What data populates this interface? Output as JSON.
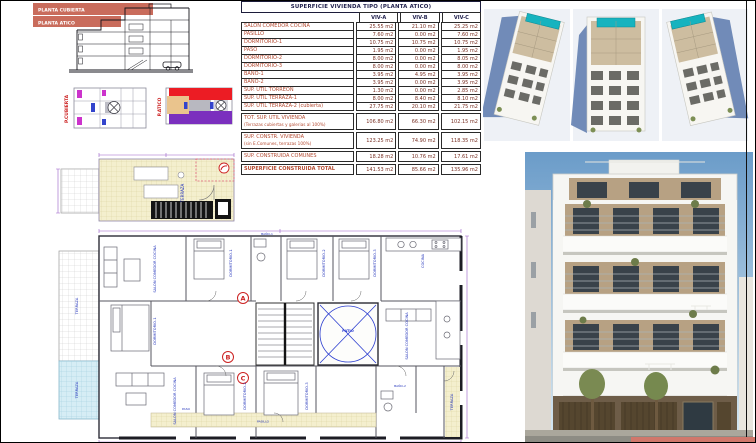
{
  "sheet": {
    "accent_band_color": "#c4604e",
    "salmon_bar_color": "#d1776b"
  },
  "section_drawing": {
    "band1": "PLANTA CUBIERTA",
    "band2": "PLANTA ATICO"
  },
  "key_plans": {
    "left_label": "P.CUBIERTA",
    "right_label": "P.ATICO"
  },
  "table": {
    "title": "SUPERFICIE VIVIENDA TIPO  (PLANTA ATICO)",
    "columns": [
      "VIV-A",
      "VIV-B",
      "VIV-C"
    ],
    "rows": [
      {
        "label": "SALON COMEDOR COCINA",
        "a": "25.55 m2",
        "b": "21.10 m2",
        "c": "25.25 m2"
      },
      {
        "label": "PASILLO",
        "a": "7.60 m2",
        "b": "0.00 m2",
        "c": "7.60 m2"
      },
      {
        "label": "DORMITORIO-1",
        "a": "10.75 m2",
        "b": "10.75 m2",
        "c": "10.75 m2"
      },
      {
        "label": "PASO",
        "a": "1.95 m2",
        "b": "0.00 m2",
        "c": "1.95 m2"
      },
      {
        "label": "DORMITORIO-2",
        "a": "8.00 m2",
        "b": "0.00 m2",
        "c": "8.05 m2"
      },
      {
        "label": "DORMITORIO-3",
        "a": "8.00 m2",
        "b": "0.00 m2",
        "c": "8.00 m2"
      },
      {
        "label": "BAÑO-1",
        "a": "3.95 m2",
        "b": "4.95 m2",
        "c": "3.95 m2"
      },
      {
        "label": "BAÑO-2",
        "a": "3.95 m2",
        "b": "0.00 m2",
        "c": "3.95 m2"
      },
      {
        "label": "SUP. ÚTIL TORREON",
        "a": "1.30 m2",
        "b": "0.00 m2",
        "c": "2.85 m2"
      },
      {
        "label": "SUP. ÚTIL TERRAZA-1",
        "a": "8.00 m2",
        "b": "8.40 m2",
        "c": "8.10 m2"
      },
      {
        "label": "SUP. ÚTIL TERRAZA-2 (cubierta)",
        "a": "27.75 m2",
        "b": "20.10 m2",
        "c": "21.75 m2"
      }
    ],
    "totals": [
      {
        "label": "TOT. SUP. UTIL VIVIENDA",
        "sub": "(Terrazas cubiertas y galerias al 100%)",
        "a": "106.80 m2",
        "b": "66.30 m2",
        "c": "102.15 m2"
      },
      {
        "label": "SUP. CONSTR. VIVIENDA",
        "sub": "(sin E.Comunes, terrazas 100%)",
        "a": "123.25 m2",
        "b": "74.90 m2",
        "c": "118.35 m2"
      },
      {
        "label": "SUP. CONSTRUIDA COMUNES",
        "sub": "",
        "a": "18.28 m2",
        "b": "10.76 m2",
        "c": "17.61 m2"
      },
      {
        "label": "SUPERFICIE CONSTRUIDA TOTAL",
        "sub": "",
        "a": "141.53 m2",
        "b": "85.66 m2",
        "c": "135.96 m2"
      }
    ]
  },
  "plan": {
    "rooms": {
      "terraza": "TERRAZA",
      "salon": "SALON COMEDOR COCINA",
      "dormitorio1": "DORMITORIO-1",
      "dormitorio2": "DORMITORIO-2",
      "dormitorio3": "DORMITORIO-3",
      "bano1": "BAÑO-1",
      "bano2": "BAÑO-2",
      "pasillo": "PASILLO",
      "paso": "PASO",
      "cocina": "COCINA",
      "patio": "PATIO"
    },
    "markers": {
      "a": "A",
      "b": "B",
      "c": "C"
    }
  }
}
